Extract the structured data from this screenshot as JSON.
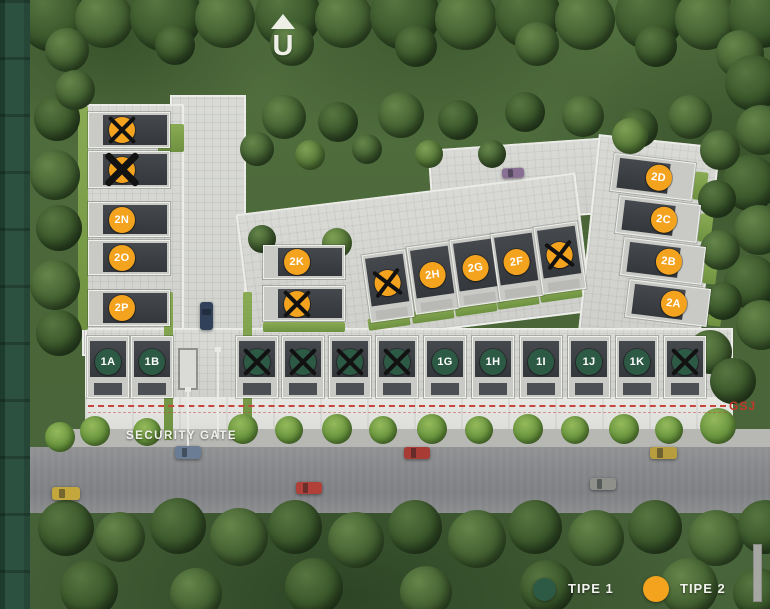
{
  "scene": {
    "name": "housing site plan"
  },
  "north": {
    "label": "U"
  },
  "annotations": {
    "security": "SECURITY",
    "gate": "GATE",
    "setback_line": "GSJ"
  },
  "legend": {
    "items": [
      {
        "label": "TIPE 1",
        "type": "1",
        "color": "#2d5a45"
      },
      {
        "label": "TIPE 2",
        "type": "2",
        "color": "#f4a31e"
      }
    ]
  },
  "colors": {
    "type1": "#2d5a45",
    "type2": "#f4a31e",
    "cross": "#121212",
    "setback": "#c4463c"
  },
  "site": {
    "groups": [
      {
        "id": "left-column",
        "units": [
          {
            "label": "",
            "type": "2",
            "crossed": true
          },
          {
            "label": "",
            "type": "2",
            "crossed": true
          },
          {
            "label": "2N",
            "type": "2",
            "crossed": false
          },
          {
            "label": "2O",
            "type": "2",
            "crossed": false
          },
          {
            "label": "2P",
            "type": "2",
            "crossed": false
          }
        ]
      },
      {
        "id": "mid-pair",
        "units": [
          {
            "label": "2K",
            "type": "2",
            "crossed": false
          },
          {
            "label": "",
            "type": "2",
            "crossed": true
          }
        ]
      },
      {
        "id": "diagonal-row",
        "units": [
          {
            "label": "",
            "type": "2",
            "crossed": true
          },
          {
            "label": "2H",
            "type": "2",
            "crossed": false
          },
          {
            "label": "2G",
            "type": "2",
            "crossed": false
          },
          {
            "label": "2F",
            "type": "2",
            "crossed": false
          },
          {
            "label": "",
            "type": "2",
            "crossed": true
          }
        ]
      },
      {
        "id": "right-column",
        "units": [
          {
            "label": "2D",
            "type": "2",
            "crossed": false
          },
          {
            "label": "2C",
            "type": "2",
            "crossed": false
          },
          {
            "label": "2B",
            "type": "2",
            "crossed": false
          },
          {
            "label": "2A",
            "type": "2",
            "crossed": false
          }
        ]
      },
      {
        "id": "front-row",
        "units": [
          {
            "label": "1A",
            "type": "1",
            "crossed": false
          },
          {
            "label": "1B",
            "type": "1",
            "crossed": false
          },
          {
            "label": "",
            "type": "1",
            "crossed": true
          },
          {
            "label": "",
            "type": "1",
            "crossed": true
          },
          {
            "label": "",
            "type": "1",
            "crossed": true
          },
          {
            "label": "",
            "type": "1",
            "crossed": true
          },
          {
            "label": "1G",
            "type": "1",
            "crossed": false
          },
          {
            "label": "1H",
            "type": "1",
            "crossed": false
          },
          {
            "label": "1I",
            "type": "1",
            "crossed": false
          },
          {
            "label": "1J",
            "type": "1",
            "crossed": false
          },
          {
            "label": "1K",
            "type": "1",
            "crossed": false
          },
          {
            "label": "",
            "type": "1",
            "crossed": true
          }
        ]
      }
    ]
  },
  "cars": [
    {
      "name": "yellow-car",
      "color": "#c3a63c"
    },
    {
      "name": "grey-blue-car-at-gate",
      "color": "#6b7d94"
    },
    {
      "name": "red-car",
      "color": "#b04038"
    },
    {
      "name": "red-car",
      "color": "#a83c34"
    },
    {
      "name": "grey-car",
      "color": "#8f9089"
    },
    {
      "name": "yellow-car",
      "color": "#b89d3e"
    },
    {
      "name": "purple-car-parked",
      "color": "#8a6f94"
    },
    {
      "name": "navy-car-driveway",
      "color": "#31415a"
    }
  ]
}
